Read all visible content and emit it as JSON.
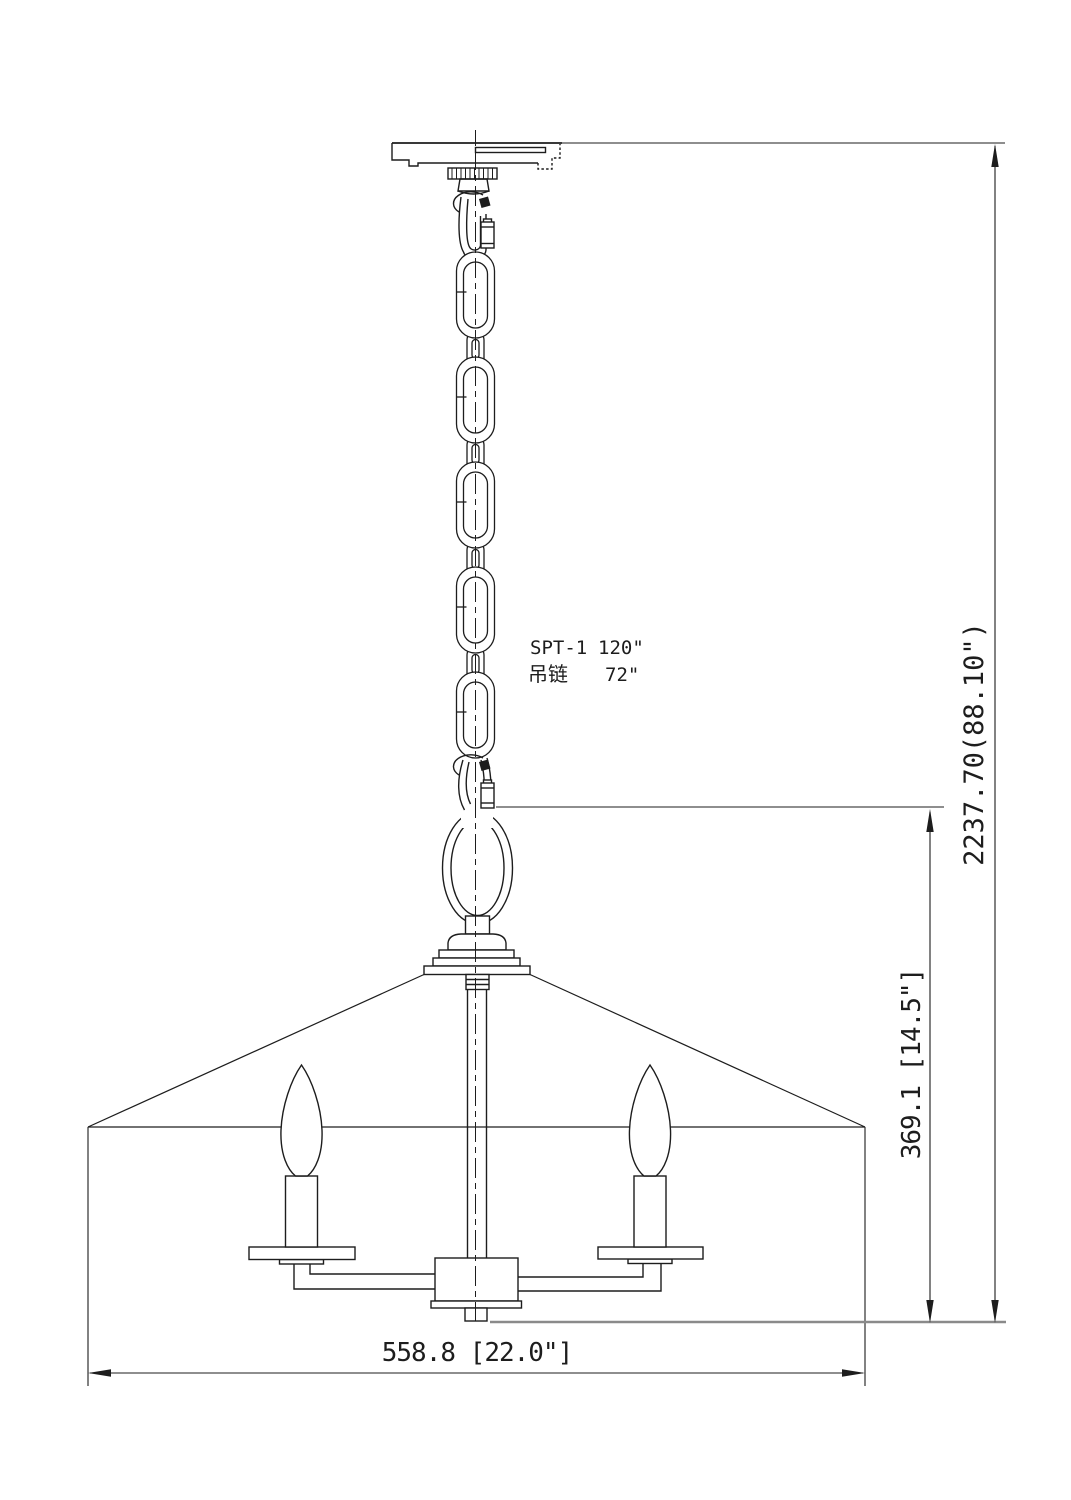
{
  "drawing": {
    "type_note": {
      "wire_label": "SPT-1",
      "wire_value": "120\"",
      "chain_label": "吊链",
      "chain_value": "72\""
    },
    "dimensions": {
      "overall_height": "2237.70(88.10\")",
      "shade_height": "369.1 [14.5\"]",
      "width": "558.8 [22.0\"]"
    },
    "colors": {
      "line": "#1d1d1d",
      "extension_line": "#8a8a8a",
      "background": "#ffffff"
    }
  }
}
